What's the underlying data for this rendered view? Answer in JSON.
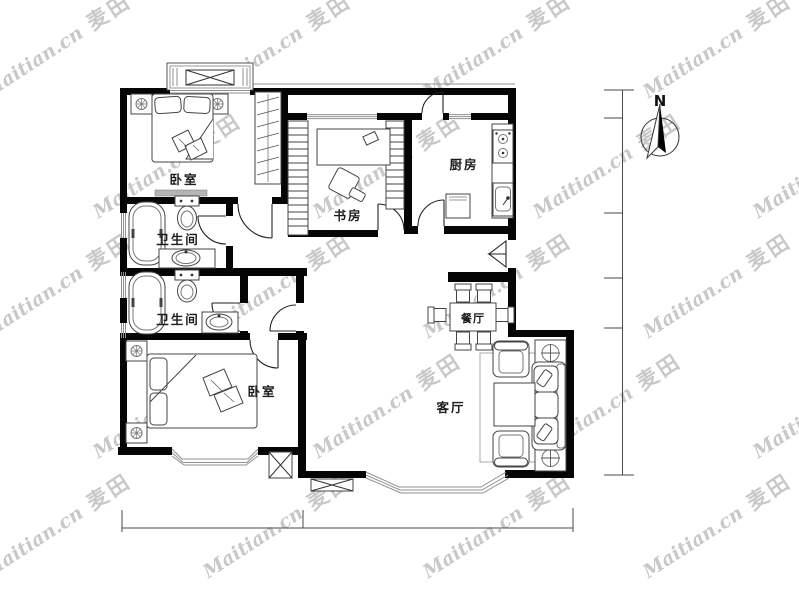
{
  "watermark": {
    "latin": "Maitian.cn",
    "cjk": "麦田"
  },
  "compass": {
    "north_label": "N"
  },
  "rooms": {
    "bedroom_top": "卧室",
    "bathroom_top": "卫生间",
    "bathroom_bottom": "卫生间",
    "study": "书房",
    "kitchen": "厨房",
    "dining": "餐厅",
    "living": "客厅",
    "bedroom_bottom": "卧室"
  },
  "colors": {
    "wall": "#050505",
    "window_line": "#909090",
    "watermark": "#c8c8c8",
    "furniture": "#444444",
    "dimension": "#4a4a4a"
  }
}
